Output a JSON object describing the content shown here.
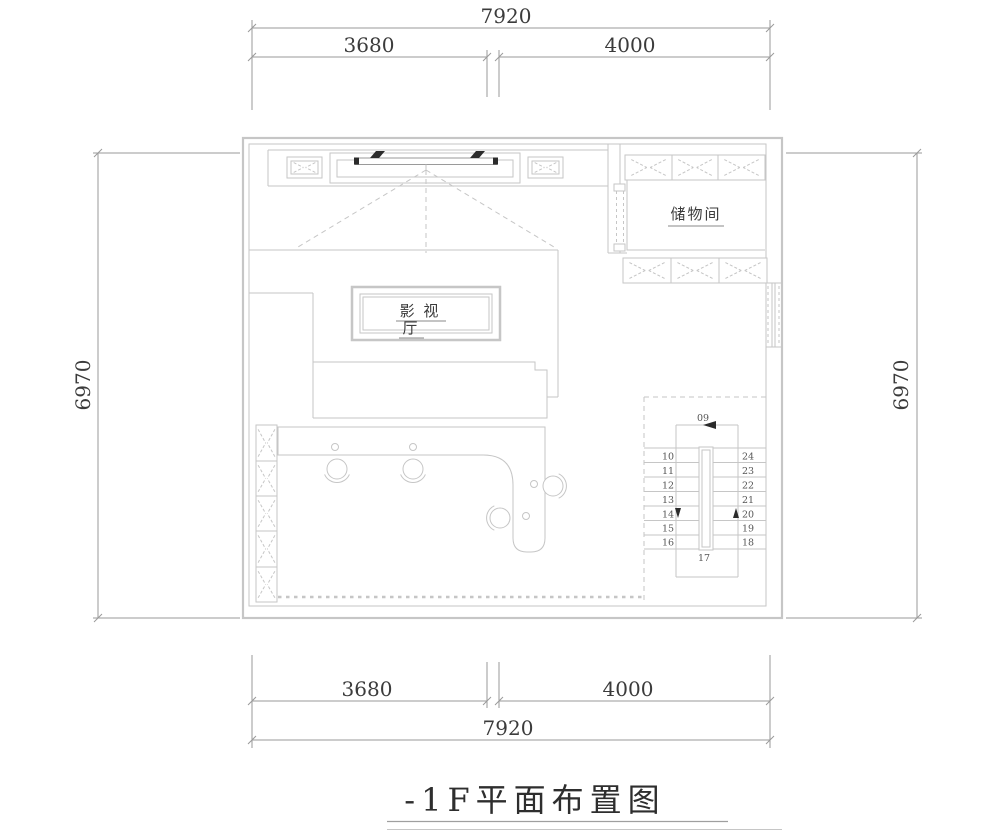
{
  "title": {
    "text": "-1F平面布置图"
  },
  "dimensions": {
    "top": {
      "total": "7920",
      "left": "3680",
      "right": "4000"
    },
    "bottom": {
      "left": "3680",
      "right": "4000",
      "total": "7920"
    },
    "left": "6970",
    "right": "6970"
  },
  "rooms": {
    "theater": {
      "name": "影视厅",
      "label_line1": "影 视",
      "label_line2": "厅"
    },
    "storage": {
      "name": "储物间"
    }
  },
  "stairs": {
    "entry": "09",
    "landing": "17",
    "left_flight": [
      "10",
      "11",
      "12",
      "13",
      "14",
      "15",
      "16"
    ],
    "right_flight": [
      "24",
      "23",
      "22",
      "21",
      "20",
      "19",
      "18"
    ]
  },
  "colors": {
    "background": "#ffffff",
    "line_gray": "#c6c6c6",
    "dim_gray": "#9a9a9a",
    "text_dark": "#3b3b3b",
    "ink_black": "#2b2b2b"
  }
}
